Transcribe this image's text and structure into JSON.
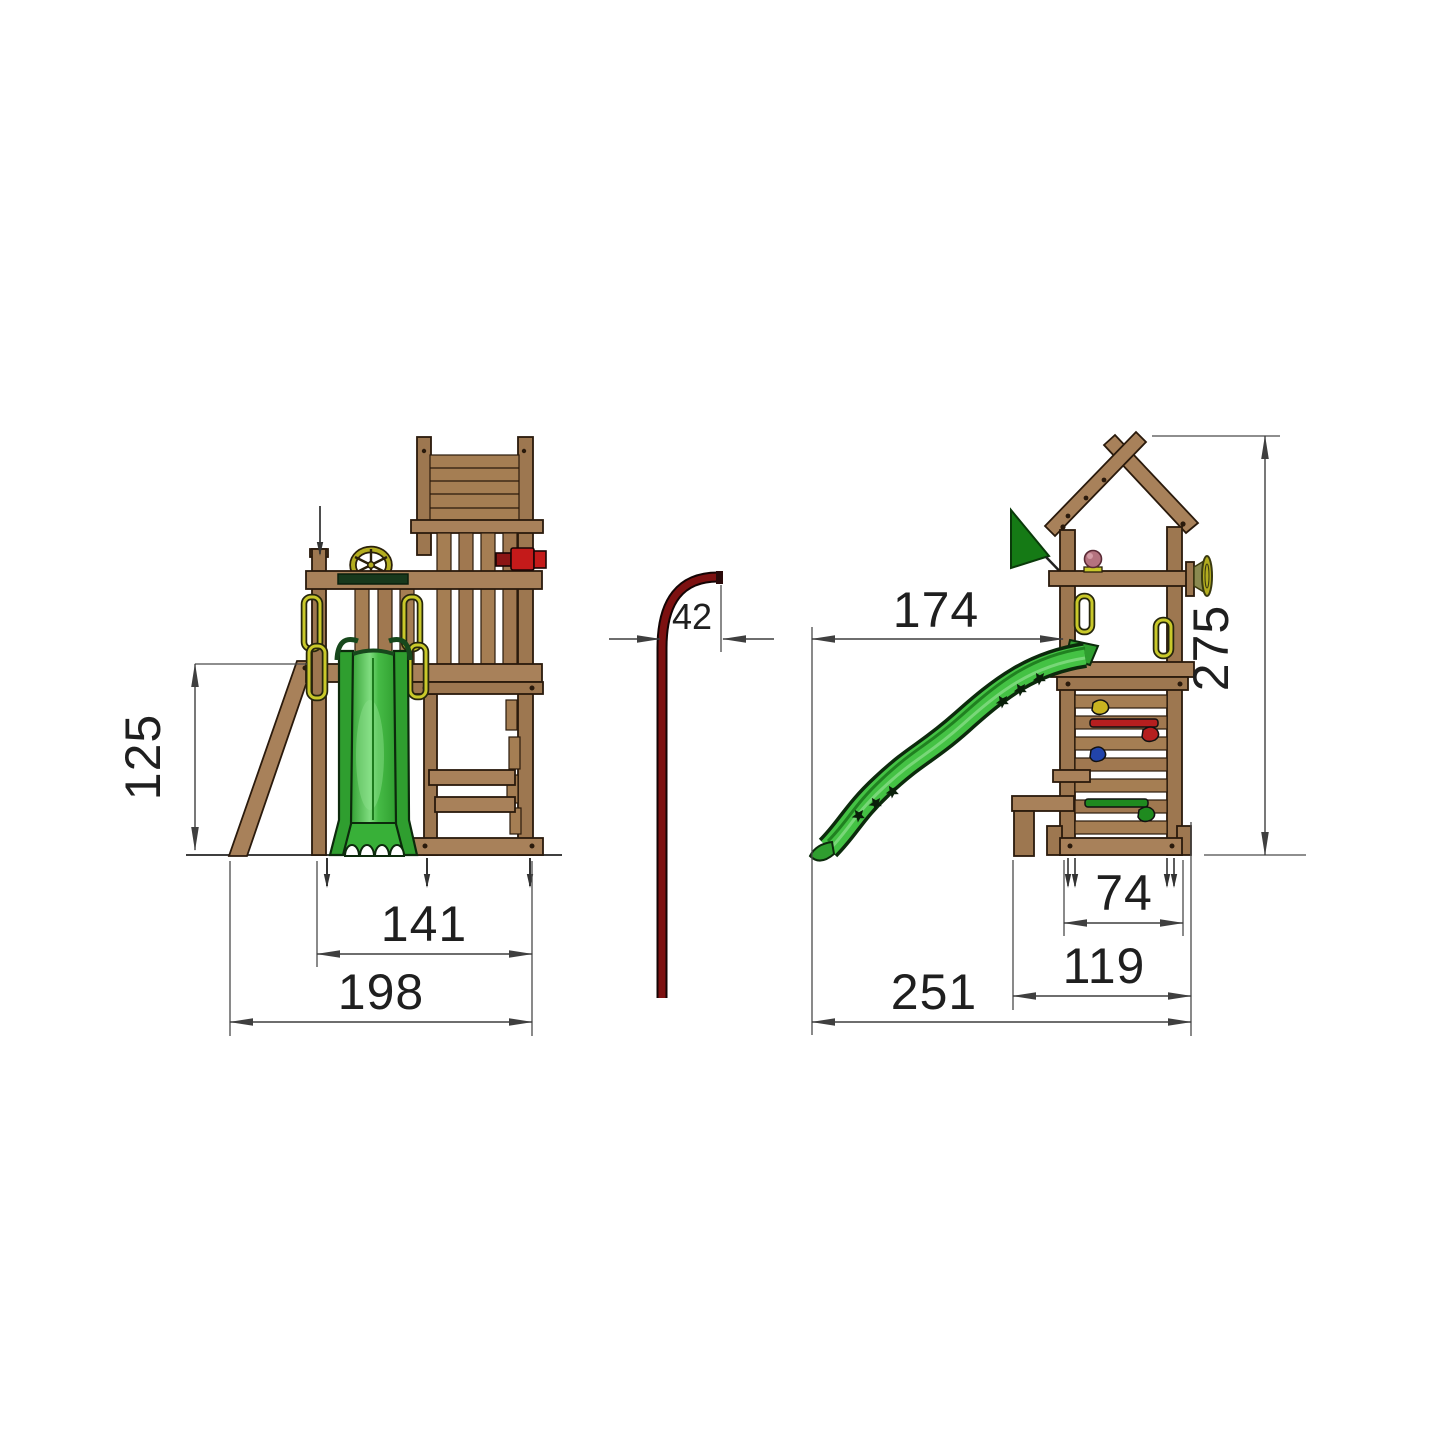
{
  "canvas": {
    "width": 1445,
    "height": 1445,
    "background": "#ffffff"
  },
  "drawing": {
    "subject": "wooden play tower dimension drawing with slide, ramp and firemans pole",
    "views": {
      "side_view": "side elevation with ramp and slide front",
      "pole_view": "firemans pole profile",
      "front_view": "front elevation with roof, flag and slide profile"
    }
  },
  "dimensions": {
    "platform_height": {
      "label": "125"
    },
    "frame_width": {
      "label": "141"
    },
    "total_width": {
      "label": "198"
    },
    "pole_offset": {
      "label": "42"
    },
    "slide_reach": {
      "label": "174"
    },
    "total_height": {
      "label": "275"
    },
    "tower_base_width": {
      "label": "74"
    },
    "base_with_bench_width": {
      "label": "119"
    },
    "total_depth": {
      "label": "251"
    }
  },
  "colors": {
    "line": "#3f3f3f",
    "text": "#1f1f1f",
    "wood": "#a8815a",
    "wood_dark": "#9d7750",
    "slide_green": "#44c244",
    "slide_green_dark": "#1d7a1d",
    "flag_green": "#157a15",
    "pole_red": "#7d1111",
    "telescope_red": "#c41a1a",
    "handle_yellow": "#c9c92a",
    "wheel_yellow": "#b3ad1f",
    "knob_pink": "#b5737f",
    "hold_red": "#b51f1f",
    "hold_blue": "#2244aa",
    "hold_yellow": "#c9b320",
    "hold_green": "#1f8a1f"
  }
}
